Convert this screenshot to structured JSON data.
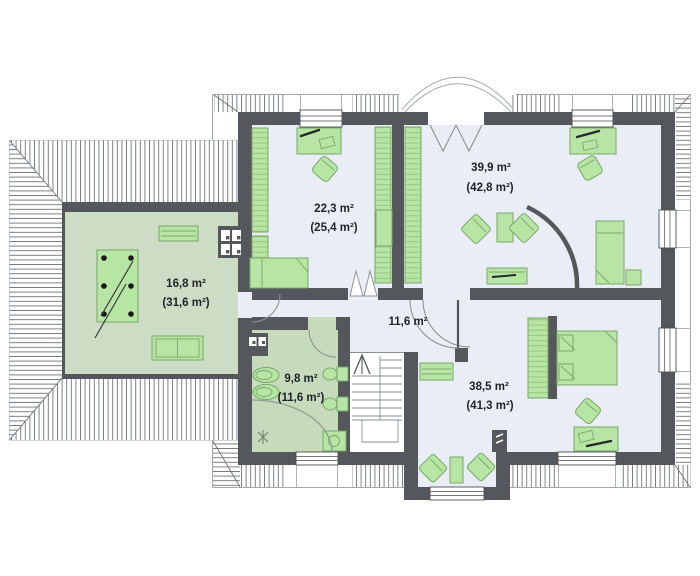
{
  "plan": {
    "type": "attic-floor-plan",
    "rooms": [
      {
        "name": "terrace",
        "area": "16,8 m²",
        "total_area": "(31,6 m²)"
      },
      {
        "name": "bedroom-upper-left",
        "area": "22,3 m²",
        "total_area": "(25,4 m²)"
      },
      {
        "name": "room-upper-right",
        "area": "39,9 m²",
        "total_area": "(42,8 m²)"
      },
      {
        "name": "hall",
        "area": "11,6 m²",
        "total_area": ""
      },
      {
        "name": "bathroom",
        "area": "9,8 m²",
        "total_area": "(11,6 m²)"
      },
      {
        "name": "bedroom-lower-right",
        "area": "38,5 m²",
        "total_area": "(41,3 m²)"
      }
    ],
    "colors": {
      "wall": "#54575c",
      "room_floor": "#e9eef6",
      "terrace_floor": "#ccdcc5",
      "bathroom_floor": "#c6dbbc",
      "furniture_fill": "#b7e5a3",
      "furniture_stroke": "#7ba56a",
      "label_text": "#1f2329",
      "roof_hatch": "#72767a"
    }
  }
}
